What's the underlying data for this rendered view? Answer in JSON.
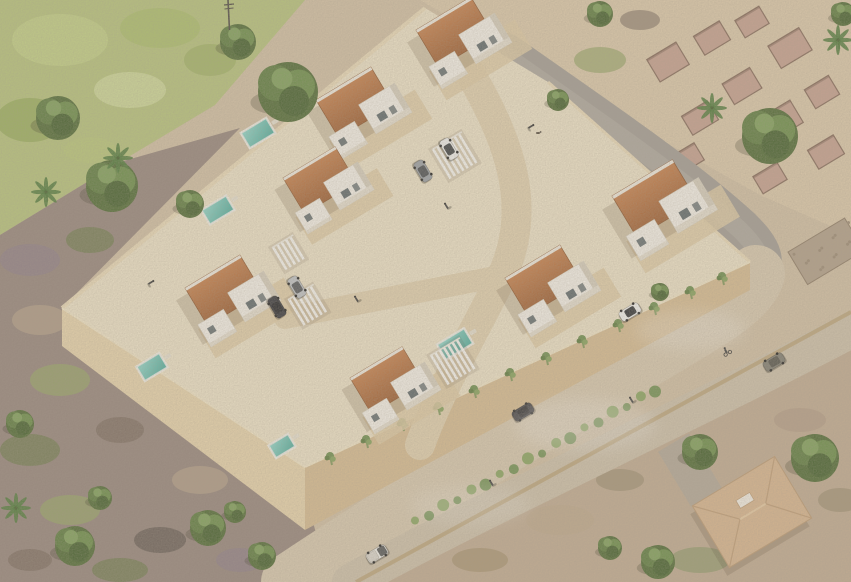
{
  "meta": {
    "description": "Aerial 3D rendering of a walled villa development: white cubic villas with terracotta roofs and turquoise pools, pergola carports with parked cars, surrounded by scrubland, ruins, curved roads with vehicles, cyclists and pedestrians, and an existing hip-roof house at lower right."
  },
  "palette": {
    "sand": "#d3c1a5",
    "sandLight": "#ddcaab",
    "moss": "#b7c47c",
    "scrubBase": "#96857c",
    "scrubRight": "#c2ac92",
    "platform": "#efe4c9",
    "wallLight": "#ecdcba",
    "wallFaceSW": "#e9d5ad",
    "wallFaceSE": "#d8bd92",
    "outerWall": "#e9d9b6",
    "outerWallShadow": "#c3ab82",
    "asphalt": "#a39d95",
    "asphaltWorn": "#b8b1a8",
    "road": "#d9cab0",
    "road2": "#cfc2ab",
    "lowWall": "#bfa87f",
    "innerStreet": "#e3d2b0",
    "deck": "#e0cda6",
    "roofTop": "#c87f4a",
    "roofBottom": "#9c5c30",
    "roofEdge": "#8a5128",
    "whiteTop": "#f6f2ea",
    "whiteSide": "#d8d0bf",
    "whiteFace": "#e7e0d1",
    "glass": "#4e5a5e",
    "poolLight": "#8fd8cc",
    "poolDark": "#4fae9f",
    "hedge1": "#6e8f4e",
    "hedge2": "#86a35c",
    "ruinFill": "#c59d8e",
    "ruinEdge": "#7e6152",
    "stoneWall": "#b2a08a",
    "treeDark": "#44602c",
    "tree1": "#4f6a33",
    "tree2": "#5d7c3e",
    "tree3": "#6b8d48",
    "treeHi": "#7fa05a",
    "palm": "#4f7a3a",
    "trunk": "#7a6a50",
    "person": "#3a3a3a",
    "houseRoof": "#d9b68f",
    "houseRidge": "#c19e77",
    "driveway": "#b2a89a"
  },
  "scene": {
    "villas": [
      {
        "x": 416,
        "y": 30,
        "s": 1.0
      },
      {
        "x": 316,
        "y": 100,
        "s": 1.0
      },
      {
        "x": 283,
        "y": 178,
        "s": 0.95
      },
      {
        "x": 185,
        "y": 288,
        "s": 1.0
      },
      {
        "x": 350,
        "y": 378,
        "s": 0.95
      },
      {
        "x": 612,
        "y": 196,
        "s": 1.1
      },
      {
        "x": 505,
        "y": 278,
        "s": 1.0
      }
    ],
    "pools": [
      {
        "x": 258,
        "y": 133,
        "w": 28,
        "h": 16
      },
      {
        "x": 218,
        "y": 210,
        "w": 27,
        "h": 15
      },
      {
        "x": 152,
        "y": 367,
        "w": 25,
        "h": 15
      },
      {
        "x": 282,
        "y": 446,
        "w": 21,
        "h": 13
      },
      {
        "x": 455,
        "y": 344,
        "w": 30,
        "h": 16
      }
    ],
    "pergolas": [
      {
        "x": 432,
        "y": 150,
        "len": 34,
        "n": 7
      },
      {
        "x": 288,
        "y": 300,
        "len": 30,
        "n": 6
      },
      {
        "x": 430,
        "y": 356,
        "len": 34,
        "n": 7
      },
      {
        "x": 272,
        "y": 248,
        "len": 26,
        "n": 5
      }
    ],
    "trees": [
      {
        "x": 288,
        "y": 92,
        "r": 30
      },
      {
        "x": 238,
        "y": 42,
        "r": 18
      },
      {
        "x": 112,
        "y": 186,
        "r": 26
      },
      {
        "x": 58,
        "y": 118,
        "r": 22
      },
      {
        "x": 190,
        "y": 204,
        "r": 14
      },
      {
        "x": 600,
        "y": 14,
        "r": 13
      },
      {
        "x": 843,
        "y": 14,
        "r": 12
      },
      {
        "x": 770,
        "y": 136,
        "r": 28
      },
      {
        "x": 558,
        "y": 100,
        "r": 11
      },
      {
        "x": 660,
        "y": 292,
        "r": 9
      },
      {
        "x": 815,
        "y": 458,
        "r": 24
      },
      {
        "x": 700,
        "y": 452,
        "r": 18
      },
      {
        "x": 658,
        "y": 562,
        "r": 17
      },
      {
        "x": 610,
        "y": 548,
        "r": 12
      },
      {
        "x": 208,
        "y": 528,
        "r": 18
      },
      {
        "x": 262,
        "y": 556,
        "r": 14
      },
      {
        "x": 75,
        "y": 546,
        "r": 20
      },
      {
        "x": 20,
        "y": 424,
        "r": 14
      },
      {
        "x": 100,
        "y": 498,
        "r": 12
      },
      {
        "x": 235,
        "y": 512,
        "r": 11
      }
    ],
    "palms": [
      {
        "x": 118,
        "y": 158
      },
      {
        "x": 46,
        "y": 192
      },
      {
        "x": 712,
        "y": 108
      },
      {
        "x": 838,
        "y": 40
      },
      {
        "x": 16,
        "y": 508
      }
    ],
    "ruins": [
      {
        "x": 668,
        "y": 62,
        "w": 34,
        "h": 26
      },
      {
        "x": 712,
        "y": 38,
        "w": 30,
        "h": 22
      },
      {
        "x": 752,
        "y": 22,
        "w": 28,
        "h": 20
      },
      {
        "x": 790,
        "y": 48,
        "w": 36,
        "h": 26
      },
      {
        "x": 742,
        "y": 86,
        "w": 32,
        "h": 24
      },
      {
        "x": 700,
        "y": 118,
        "w": 30,
        "h": 22
      },
      {
        "x": 782,
        "y": 120,
        "w": 34,
        "h": 26
      },
      {
        "x": 822,
        "y": 92,
        "w": 28,
        "h": 22
      },
      {
        "x": 826,
        "y": 152,
        "w": 30,
        "h": 22
      },
      {
        "x": 688,
        "y": 158,
        "w": 26,
        "h": 20
      },
      {
        "x": 770,
        "y": 178,
        "w": 28,
        "h": 20
      }
    ],
    "ivy": [
      {
        "x": 330,
        "y": 456
      },
      {
        "x": 366,
        "y": 439
      },
      {
        "x": 402,
        "y": 422
      },
      {
        "x": 438,
        "y": 406
      },
      {
        "x": 474,
        "y": 389
      },
      {
        "x": 510,
        "y": 372
      },
      {
        "x": 546,
        "y": 356
      },
      {
        "x": 582,
        "y": 339
      },
      {
        "x": 618,
        "y": 323
      },
      {
        "x": 654,
        "y": 306
      },
      {
        "x": 690,
        "y": 290
      },
      {
        "x": 722,
        "y": 276
      }
    ],
    "hedge": {
      "x1": 415,
      "y1": 522,
      "x2": 655,
      "y2": 390,
      "n": 18
    },
    "cars": [
      {
        "x": 630,
        "y": 312,
        "a": -31,
        "c": "#f4f4f2",
        "cab": "#2e3135",
        "t": "suv"
      },
      {
        "x": 523,
        "y": 412,
        "a": -31,
        "c": "#3b3b40",
        "cab": "#26262a",
        "t": "sedan"
      },
      {
        "x": 774,
        "y": 362,
        "a": -31,
        "c": "#7f7d72",
        "cab": "#55544c",
        "t": "sedan"
      },
      {
        "x": 377,
        "y": 554,
        "a": -31,
        "c": "#f2f1ec",
        "cab": "#3a3d40",
        "t": "pickup"
      },
      {
        "x": 449,
        "y": 149,
        "a": 59,
        "c": "#f2f2f0",
        "cab": "#3c4043",
        "t": "sedan"
      },
      {
        "x": 423,
        "y": 171,
        "a": 59,
        "c": "#9aa0a6",
        "cab": "#4a4e52",
        "t": "sedan"
      },
      {
        "x": 297,
        "y": 287,
        "a": 59,
        "c": "#c0c4c8",
        "cab": "#54585c",
        "t": "sedan"
      },
      {
        "x": 277,
        "y": 307,
        "a": 59,
        "c": "#33343a",
        "cab": "#222327",
        "t": "suv"
      }
    ],
    "people": [
      {
        "x": 447,
        "y": 207,
        "a": -31
      },
      {
        "x": 530,
        "y": 127,
        "a": 59
      },
      {
        "x": 492,
        "y": 484,
        "a": -31
      },
      {
        "x": 632,
        "y": 401,
        "a": -31
      },
      {
        "x": 150,
        "y": 283,
        "a": 59
      },
      {
        "x": 357,
        "y": 300,
        "a": -31
      }
    ],
    "cyclist": {
      "x": 727,
      "y": 352
    },
    "dog": {
      "x": 538,
      "y": 133
    },
    "pole": {
      "x": 228,
      "y": 0,
      "h": 30
    },
    "stoneWall": {
      "x": 788,
      "y": 252,
      "w": 66,
      "h": 38
    },
    "house": {
      "x": 752,
      "y": 512,
      "w": 96,
      "h": 72
    },
    "driveway": {
      "x": 690,
      "y": 470,
      "w": 36,
      "h": 64
    },
    "mossBlobs": [
      {
        "x": 60,
        "y": 40,
        "rx": 48,
        "ry": 26,
        "c": "#c6d488"
      },
      {
        "x": 160,
        "y": 28,
        "rx": 40,
        "ry": 20,
        "c": "#aabf68"
      },
      {
        "x": 30,
        "y": 120,
        "rx": 34,
        "ry": 22,
        "c": "#93ab55"
      },
      {
        "x": 130,
        "y": 90,
        "rx": 36,
        "ry": 18,
        "c": "#d4dfa0"
      },
      {
        "x": 210,
        "y": 60,
        "rx": 26,
        "ry": 16,
        "c": "#9db162"
      },
      {
        "x": 90,
        "y": 150,
        "rx": 26,
        "ry": 13,
        "c": "#b9c87a"
      }
    ],
    "scrubBlobs": [
      {
        "x": 30,
        "y": 260,
        "rx": 30,
        "ry": 16,
        "c": "#8d7d88"
      },
      {
        "x": 90,
        "y": 240,
        "rx": 24,
        "ry": 13,
        "c": "#6e7b4c"
      },
      {
        "x": 40,
        "y": 320,
        "rx": 28,
        "ry": 15,
        "c": "#b5a28a"
      },
      {
        "x": 110,
        "y": 300,
        "rx": 20,
        "ry": 12,
        "c": "#5f564f"
      },
      {
        "x": 60,
        "y": 380,
        "rx": 30,
        "ry": 16,
        "c": "#96a565"
      },
      {
        "x": 140,
        "y": 360,
        "rx": 22,
        "ry": 12,
        "c": "#8d7d88"
      },
      {
        "x": 30,
        "y": 450,
        "rx": 30,
        "ry": 16,
        "c": "#6e7b4c"
      },
      {
        "x": 120,
        "y": 430,
        "rx": 24,
        "ry": 13,
        "c": "#7a6a5e"
      },
      {
        "x": 200,
        "y": 480,
        "rx": 28,
        "ry": 14,
        "c": "#b5a28a"
      },
      {
        "x": 70,
        "y": 510,
        "rx": 30,
        "ry": 15,
        "c": "#96a565"
      },
      {
        "x": 160,
        "y": 540,
        "rx": 26,
        "ry": 13,
        "c": "#5f564f"
      },
      {
        "x": 240,
        "y": 560,
        "rx": 24,
        "ry": 12,
        "c": "#8d7d88"
      },
      {
        "x": 120,
        "y": 570,
        "rx": 28,
        "ry": 12,
        "c": "#6e7b4c"
      },
      {
        "x": 30,
        "y": 560,
        "rx": 22,
        "ry": 11,
        "c": "#7a6a5e"
      },
      {
        "x": 560,
        "y": 520,
        "rx": 34,
        "ry": 15,
        "c": "#bfa98c"
      },
      {
        "x": 480,
        "y": 560,
        "rx": 28,
        "ry": 12,
        "c": "#a5916e"
      },
      {
        "x": 620,
        "y": 480,
        "rx": 24,
        "ry": 11,
        "c": "#9d8f72"
      },
      {
        "x": 700,
        "y": 560,
        "rx": 30,
        "ry": 13,
        "c": "#8f9a6a"
      },
      {
        "x": 800,
        "y": 420,
        "rx": 26,
        "ry": 12,
        "c": "#b39c85"
      },
      {
        "x": 840,
        "y": 500,
        "rx": 22,
        "ry": 12,
        "c": "#9d8f72"
      },
      {
        "x": 600,
        "y": 60,
        "rx": 26,
        "ry": 13,
        "c": "#9aa76a"
      },
      {
        "x": 640,
        "y": 20,
        "rx": 20,
        "ry": 10,
        "c": "#8d7d6e"
      }
    ],
    "haze": [
      {
        "x": 585,
        "y": 425,
        "rx": 70,
        "ry": 26,
        "o": 0.22
      },
      {
        "x": 690,
        "y": 330,
        "rx": 55,
        "ry": 20,
        "o": 0.2
      },
      {
        "x": 470,
        "y": 505,
        "rx": 60,
        "ry": 20,
        "o": 0.15
      }
    ]
  }
}
